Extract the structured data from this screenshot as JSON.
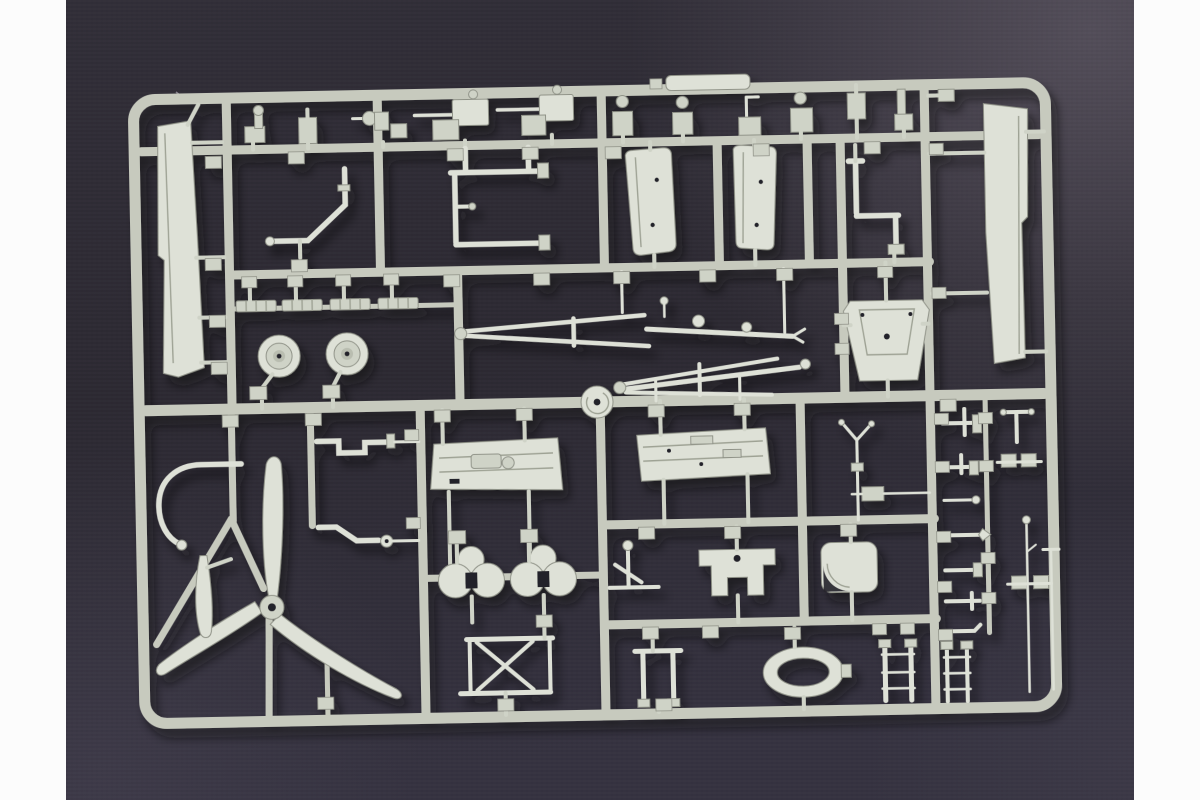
{
  "scene": {
    "type": "photograph",
    "subject": "Plastic model kit sprue of light grey injection-molded aircraft parts on a dark fabric background, letterboxed by white vertical bars",
    "orientation": "landscape",
    "tilt_degrees": -1.1
  },
  "colors": {
    "letterbox": "#fcfcfc",
    "background_dark": "#2e2b33",
    "background_mid": "#39353f",
    "background_light": "#6a6370",
    "sprue_main": "#c7cabe",
    "sprue_light": "#dbded4",
    "sprue_shadow": "#8f9287",
    "part_fill": "#cfd3c7",
    "part_light": "#dee1d7",
    "hub_mid": "#b9bdb0",
    "hole_dark": "#24212a",
    "cast_shadow": "#0c0a10"
  },
  "sprue": {
    "frame_label": "outer runner frame with rounded corners",
    "gate_boss_label": "round sprue gate boss at runner crossing",
    "parts": [
      {
        "id": "left-slat",
        "label": "long wing slat / flap (left column)"
      },
      {
        "id": "right-slat",
        "label": "long wing slat / flap (right column)"
      },
      {
        "id": "top-row-fittings",
        "label": "top row of small fittings and two machine guns"
      },
      {
        "id": "zigzag-pipe",
        "label": "bent pipe linkage"
      },
      {
        "id": "manifold-pipe",
        "label": "C-shaped manifold pipe with flanged ends"
      },
      {
        "id": "gear-door-left",
        "label": "landing-gear door"
      },
      {
        "id": "gear-door-right",
        "label": "landing-gear door"
      },
      {
        "id": "tail-wheel-strut",
        "label": "tail-wheel strut"
      },
      {
        "id": "tread-strips",
        "label": "four ribbed tread strips"
      },
      {
        "id": "main-wheel-a",
        "label": "main wheel disc"
      },
      {
        "id": "main-wheel-b",
        "label": "main wheel disc"
      },
      {
        "id": "gear-leg-a",
        "label": "landing-gear leg truss assembly"
      },
      {
        "id": "gear-leg-b",
        "label": "landing-gear leg truss assembly"
      },
      {
        "id": "pilot-seat",
        "label": "bucket pilot seat"
      },
      {
        "id": "propeller",
        "label": "three-blade propeller"
      },
      {
        "id": "spare-blade",
        "label": "single spare propeller blade"
      },
      {
        "id": "horseshoe-bracket",
        "label": "curved horseshoe bracket"
      },
      {
        "id": "linkage-a",
        "label": "stepped linkage rod"
      },
      {
        "id": "linkage-b",
        "label": "stepped linkage rod with eyelet"
      },
      {
        "id": "floor-panel",
        "label": "detailed cockpit floor panel"
      },
      {
        "id": "side-panel",
        "label": "detailed cockpit console panel"
      },
      {
        "id": "hub-cluster-a",
        "label": "trefoil wheel-hub disc cluster"
      },
      {
        "id": "hub-cluster-b",
        "label": "trefoil wheel-hub disc cluster"
      },
      {
        "id": "cradle-table",
        "label": "X-leg cradle frame"
      },
      {
        "id": "control-column",
        "label": "control column lever"
      },
      {
        "id": "engine-mount",
        "label": "stepped engine-mount bracket"
      },
      {
        "id": "intake-scoop",
        "label": "air-intake scoop with dark mouth"
      },
      {
        "id": "oval-ring",
        "label": "oval cowl ring"
      },
      {
        "id": "rail-pair",
        "label": "twin-prong bracket"
      },
      {
        "id": "ladder-rails",
        "label": "short runged rail pair"
      },
      {
        "id": "right-column-fittings",
        "label": "column of small brackets, masts and antennas"
      },
      {
        "id": "pitot-tubes",
        "label": "two long thin pitot tubes"
      },
      {
        "id": "gate-tabs",
        "label": "rectangular sprue gate tabs"
      }
    ]
  }
}
